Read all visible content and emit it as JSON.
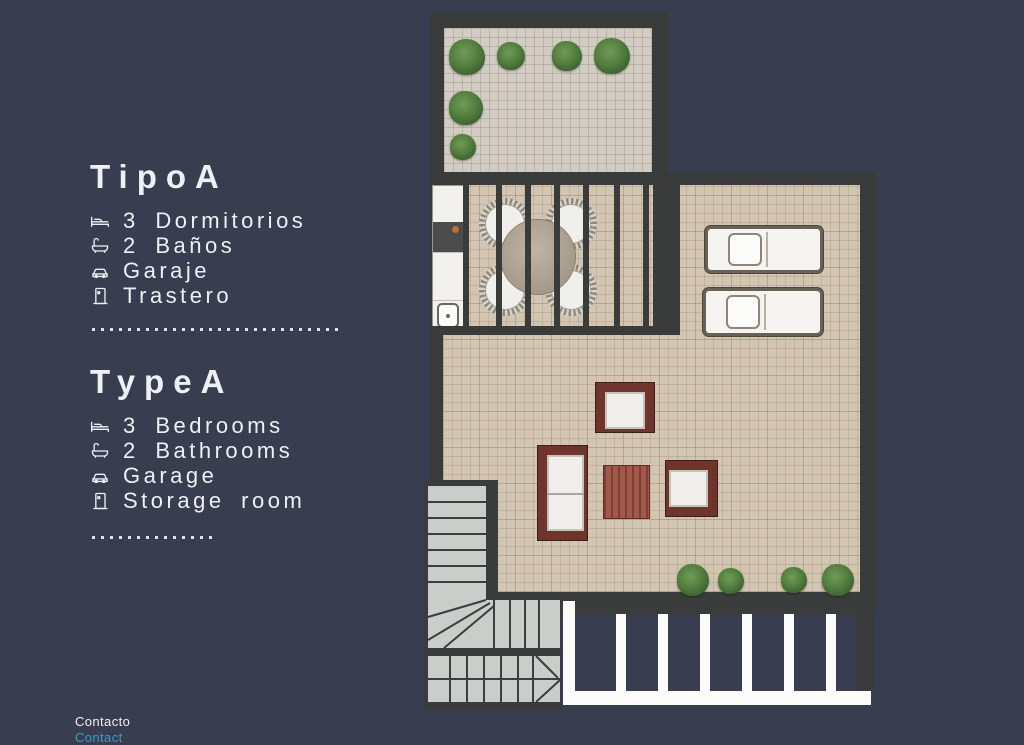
{
  "info_panel": {
    "es": {
      "title": "TipoA",
      "items": [
        {
          "icon": "bed-icon",
          "label": "3 Dormitorios"
        },
        {
          "icon": "bath-icon",
          "label": "2 Baños"
        },
        {
          "icon": "car-icon",
          "label": "Garaje"
        },
        {
          "icon": "door-icon",
          "label": "Trastero"
        }
      ]
    },
    "en": {
      "title": "TypeA",
      "items": [
        {
          "icon": "bed-icon",
          "label": "3 Bedrooms"
        },
        {
          "icon": "bath-icon",
          "label": "2 Bathrooms"
        },
        {
          "icon": "car-icon",
          "label": "Garage"
        },
        {
          "icon": "door-icon",
          "label": "Storage room"
        }
      ]
    },
    "contact": {
      "line1": "Contacto",
      "line2": "Contact"
    }
  },
  "colors": {
    "bg": "#383e50",
    "wall": "#3a3c3b",
    "terrace_floor": "#d3ccc3",
    "main_floor": "#d2c5b2",
    "accent_cyan": "#3c9cc4",
    "text": "#eef0f3",
    "frame_maroon": "#6f342c",
    "plant_green": "#527e3e",
    "table_brick": "#a2584b"
  }
}
